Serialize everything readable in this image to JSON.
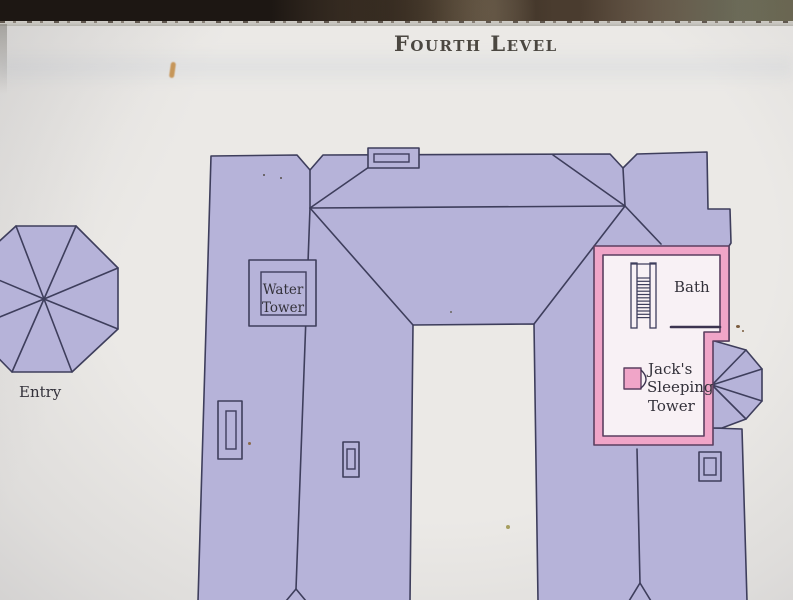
{
  "sign": {
    "title": "Fourth Level"
  },
  "map": {
    "labels": {
      "entry": "Entry",
      "water_tower_lines": [
        "Water",
        "Tower"
      ],
      "bath": "Bath",
      "jacks_tower_lines": [
        "Jack's",
        "Sleeping",
        "Tower"
      ]
    },
    "icons": [
      "staircase-icon",
      "door-swing-icon",
      "chimney-icon",
      "turret-bay-icon"
    ],
    "colors": {
      "roof_fill": "#b6b3d9",
      "outline": "#3e3e5c",
      "highlight_pink": "#f0a5c8",
      "highlight_outline": "#5a3f60",
      "room_interior": "#f8f1f5",
      "paper": "#ebe9e6",
      "title_color": "#4b4741",
      "label_color": "#33313a",
      "photo_band": "#352c25"
    }
  }
}
